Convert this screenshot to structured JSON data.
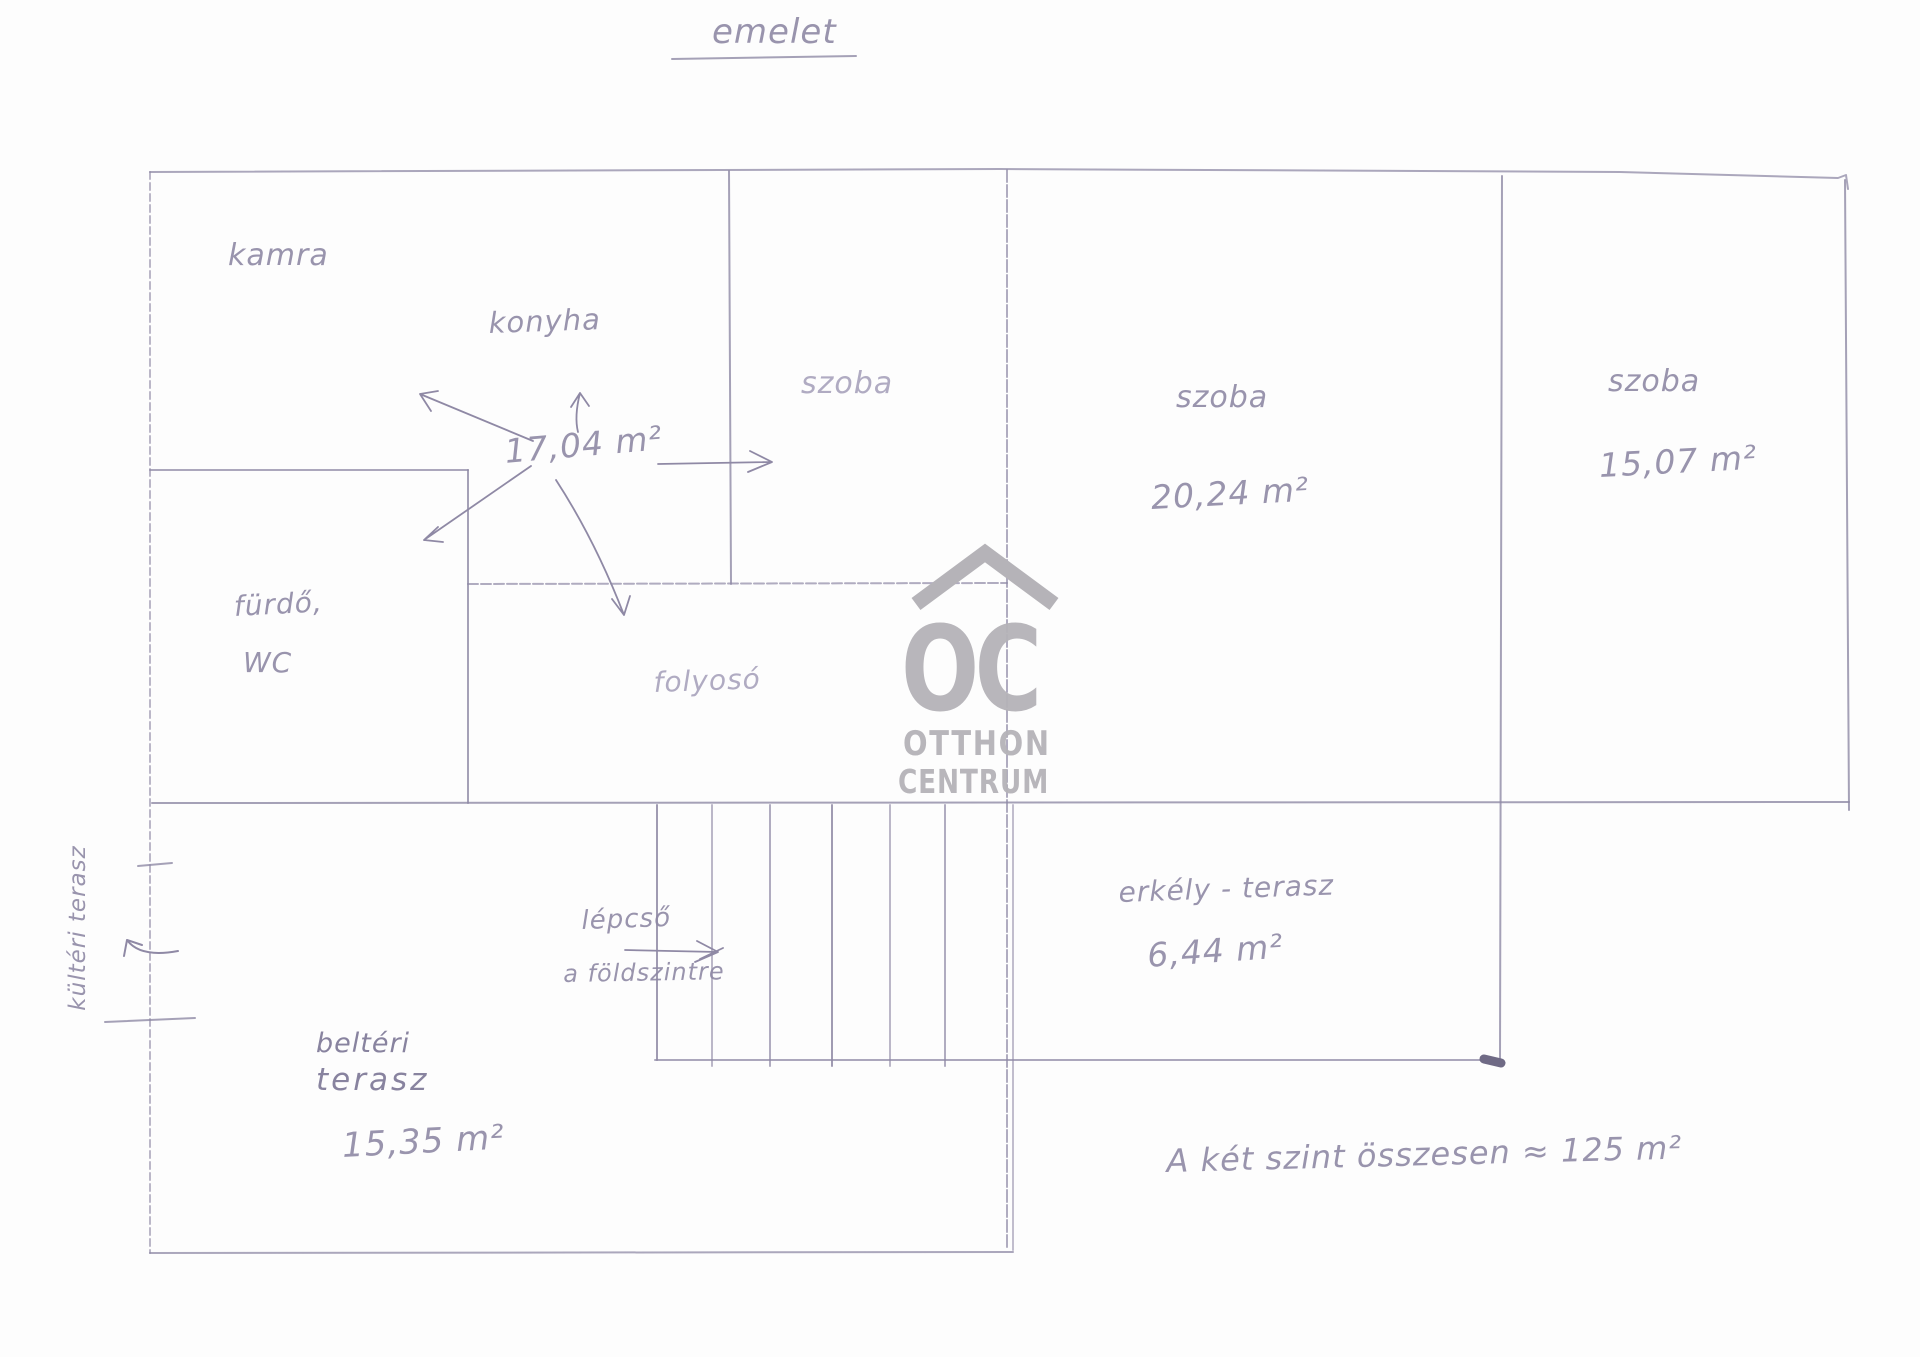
{
  "title": {
    "text": "emelet"
  },
  "rooms": {
    "kamra": {
      "label": "kamra"
    },
    "konyha": {
      "label": "konyha",
      "area": "17,04 m²"
    },
    "szoba_1": {
      "label": "szoba"
    },
    "szoba_2": {
      "label": "szoba",
      "area": "20,24 m²"
    },
    "szoba_3": {
      "label": "szoba",
      "area": "15,07 m²"
    },
    "furdo_wc": {
      "line1": "fürdő,",
      "line2": "WC"
    },
    "folyoso": {
      "label": "folyosó"
    }
  },
  "lower_level": {
    "lepcso": {
      "line1": "lépcső",
      "line2": "a földszintre"
    },
    "erkely_terasz": {
      "label": "erkély - terasz",
      "area": "6,44 m²"
    },
    "belteri_terasz": {
      "line1": "beltéri",
      "line2": "terasz",
      "area": "15,35 m²"
    },
    "kulteri_terasz": {
      "label": "kültéri terasz"
    }
  },
  "summary": {
    "text": "A két szint összesen ≈ 125 m²"
  },
  "watermark": {
    "monogram": "OC",
    "line1": "OTTHON",
    "line2": "CENTRUM"
  },
  "colors": {
    "pencil": "#8f89a5",
    "pencil_light": "#a8a3bc",
    "pencil_dark": "#7c7695",
    "watermark_gray": "#b5b3b8",
    "paper": "#fdfdfd"
  }
}
